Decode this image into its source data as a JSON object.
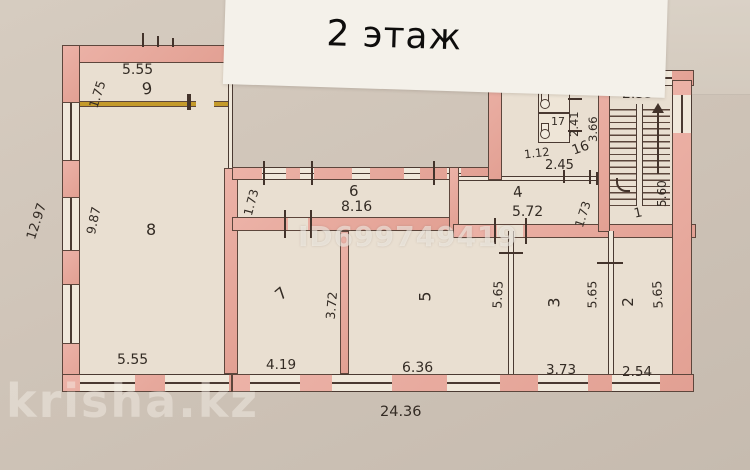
{
  "title": "2 этаж",
  "watermarks": {
    "id": "ID699749419",
    "site": "krisha.kz"
  },
  "rooms": {
    "r9": {
      "num": "9",
      "width": "5.55",
      "depth": "1.75"
    },
    "r8": {
      "num": "8",
      "width": "5.55",
      "depth": "9.87",
      "outer_depth": "12.97"
    },
    "r6": {
      "num": "6",
      "width": "8.16",
      "depth": "1.73"
    },
    "r4": {
      "num": "4",
      "width": "5.72",
      "depth": "1.73"
    },
    "r18": {
      "num": "18"
    },
    "r17": {
      "num": "17"
    },
    "wc": {
      "width": "1.12",
      "depth": "2.41"
    },
    "r16": {
      "num": "16",
      "width": "2.45",
      "depth": "3.66"
    },
    "stairs": {
      "width": "2.55",
      "depth": "5.60"
    },
    "r1": {
      "num": "1"
    },
    "r7": {
      "num": "7",
      "width": "4.19",
      "depth": "3.72"
    },
    "r5": {
      "num": "5",
      "width": "6.36",
      "depth": "5.65"
    },
    "r3": {
      "num": "3",
      "width": "3.73",
      "depth": "5.65"
    },
    "r2": {
      "num": "2",
      "width": "2.54",
      "depth": "5.65"
    }
  },
  "overall": {
    "width": "24.36"
  }
}
